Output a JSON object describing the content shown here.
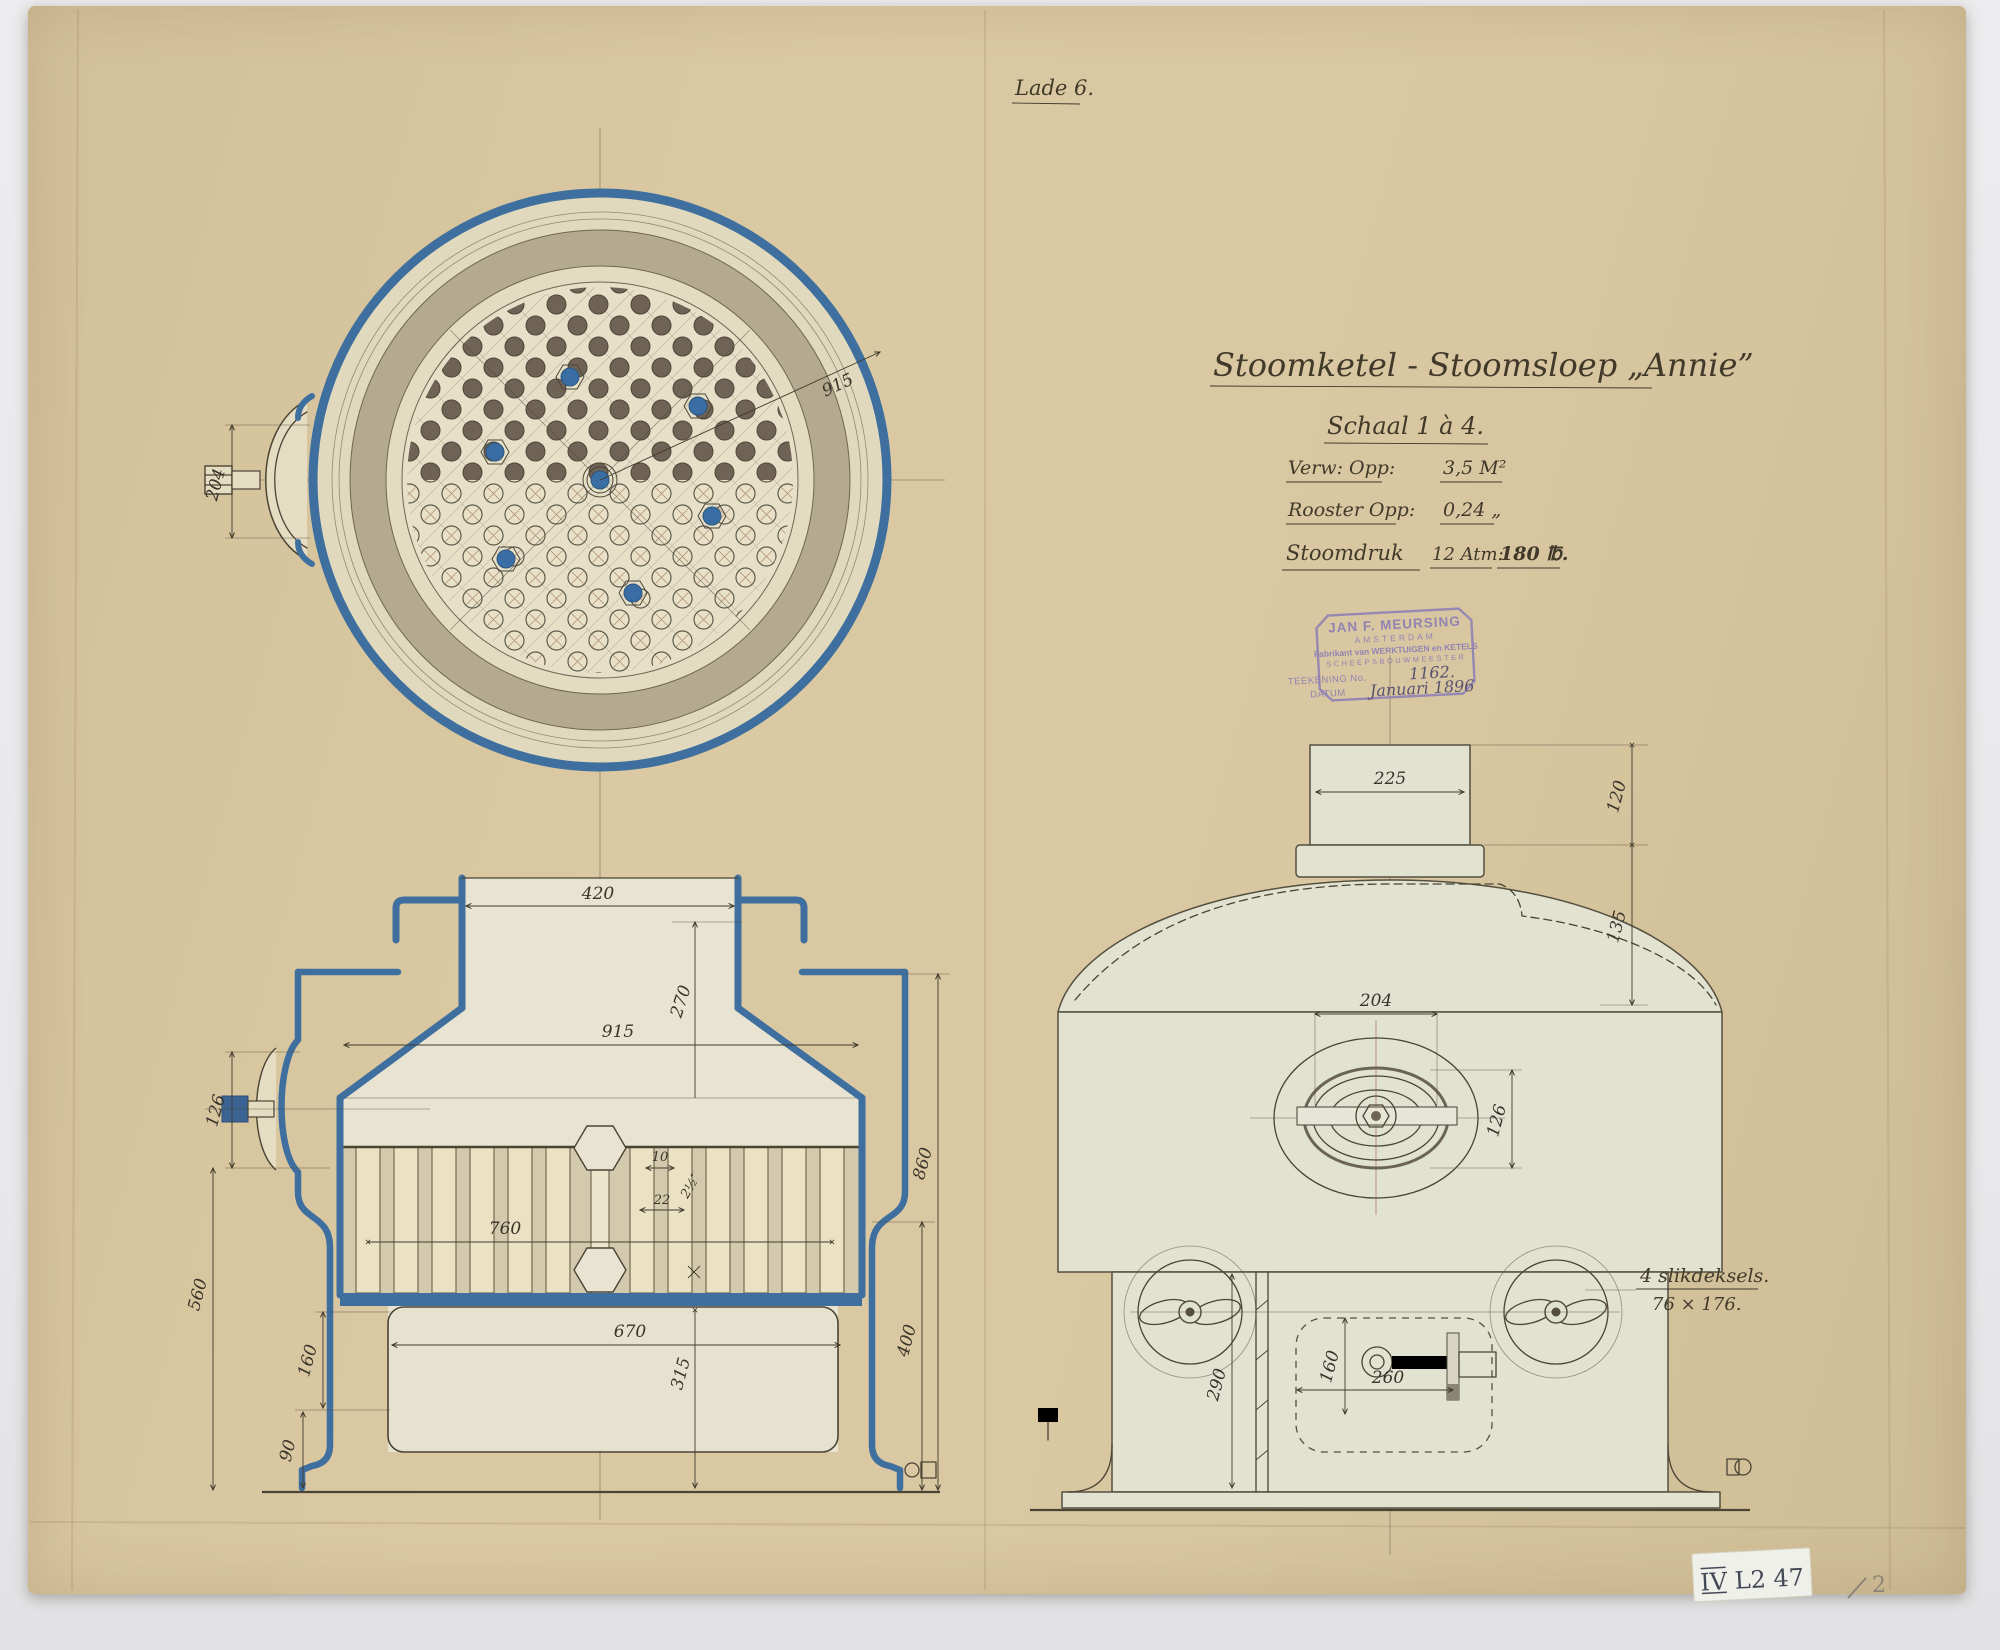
{
  "page": {
    "folder_label": "Lade 6.",
    "corner_sticker": "IV L2 47",
    "corner_pencil": "2"
  },
  "title_block": {
    "title": "Stoomketel - Stoomsloep „Annie”",
    "scale": "Schaal 1 à 4.",
    "spec1_label": "Verw: Opp:",
    "spec1_value": "3,5 M²",
    "spec2_label": "Rooster Opp:",
    "spec2_value": "0,24 „",
    "spec3_label": "Stoomdruk",
    "spec3_value1": "12 Atm:",
    "spec3_value2": "180 ℔."
  },
  "stamp": {
    "name": "JAN F. MEURSING",
    "city": "AMSTERDAM",
    "line3": "Fabrikant van WERKTUIGEN en KETELS",
    "line4": "SCHEEPSBOUWMEESTER",
    "no_label": "TEEKENING No.",
    "no_value": "1162.",
    "date_label": "DATUM",
    "date_value": "Januari 1896"
  },
  "top_view": {
    "dims": {
      "diameter": "915",
      "manhole": "204"
    }
  },
  "front_view": {
    "dims": {
      "d420": "420",
      "d270": "270",
      "d915": "915",
      "d126": "126",
      "d560": "560",
      "d160": "160",
      "d90": "90",
      "d760": "760",
      "d670": "670",
      "d315": "315",
      "d860": "860",
      "d400": "400",
      "d10": "10",
      "dtube": "2½″",
      "d22": "22"
    }
  },
  "side_view": {
    "dims": {
      "d225": "225",
      "d120": "120",
      "d135": "135",
      "d204": "204",
      "d126": "126",
      "d160": "160",
      "d260": "260",
      "d290": "290"
    },
    "note_line1": "4 slikdeksels.",
    "note_line2": "76 × 176."
  },
  "colors": {
    "paper": "#d9c7a1",
    "ink": "#4a4435",
    "section_blue": "#3f6f9e",
    "wash": "#e2e2d1",
    "tube_dark": "#6e6355",
    "stay_blue": "#3a6da3",
    "stamp_purple": "#8a7cb5"
  }
}
